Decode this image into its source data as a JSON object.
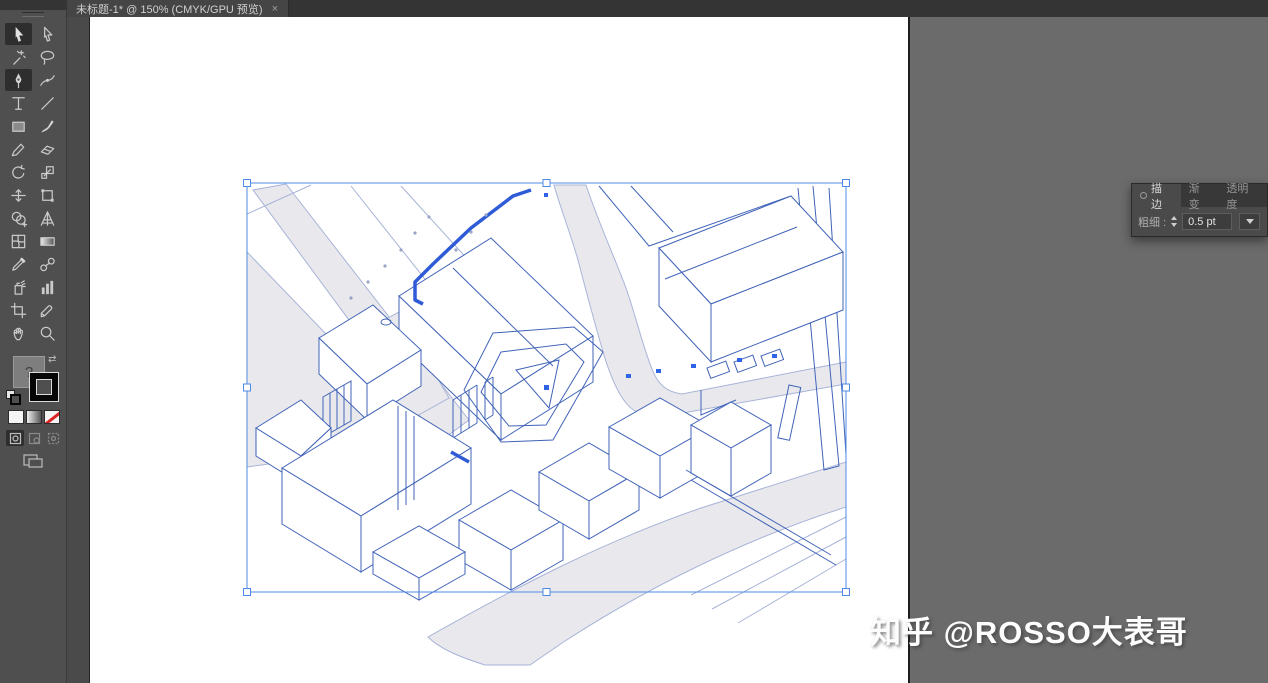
{
  "window": {
    "tab_title": "未标题-1* @ 150% (CMYK/GPU 预览)",
    "close_label": "×"
  },
  "toolbar": {
    "fill_indicator": "?",
    "tools": [
      {
        "id": "selection",
        "name": "selection-tool",
        "active": true
      },
      {
        "id": "direct-selection",
        "name": "direct-selection-tool",
        "active": false
      },
      {
        "id": "magic-wand",
        "name": "magic-wand-tool",
        "active": false
      },
      {
        "id": "lasso",
        "name": "lasso-tool",
        "active": false
      },
      {
        "id": "pen",
        "name": "pen-tool",
        "active": true
      },
      {
        "id": "curvature",
        "name": "curvature-tool",
        "active": false
      },
      {
        "id": "type",
        "name": "type-tool",
        "active": false
      },
      {
        "id": "line-segment",
        "name": "line-segment-tool",
        "active": false
      },
      {
        "id": "rectangle",
        "name": "rectangle-tool",
        "active": false
      },
      {
        "id": "paintbrush",
        "name": "paintbrush-tool",
        "active": false
      },
      {
        "id": "pencil",
        "name": "pencil-tool",
        "active": false
      },
      {
        "id": "eraser",
        "name": "eraser-tool",
        "active": false
      },
      {
        "id": "rotate",
        "name": "rotate-tool",
        "active": false
      },
      {
        "id": "scale",
        "name": "scale-tool",
        "active": false
      },
      {
        "id": "width",
        "name": "width-tool",
        "active": false
      },
      {
        "id": "free-transform",
        "name": "free-transform-tool",
        "active": false
      },
      {
        "id": "shape-builder",
        "name": "shape-builder-tool",
        "active": false
      },
      {
        "id": "perspective-grid",
        "name": "perspective-grid-tool",
        "active": false
      },
      {
        "id": "mesh",
        "name": "mesh-tool",
        "active": false
      },
      {
        "id": "gradient",
        "name": "gradient-tool",
        "active": false
      },
      {
        "id": "eyedropper",
        "name": "eyedropper-tool",
        "active": false
      },
      {
        "id": "blend",
        "name": "blend-tool",
        "active": false
      },
      {
        "id": "symbol-sprayer",
        "name": "symbol-sprayer-tool",
        "active": false
      },
      {
        "id": "column-graph",
        "name": "column-graph-tool",
        "active": false
      },
      {
        "id": "artboard",
        "name": "artboard-tool",
        "active": false
      },
      {
        "id": "slice",
        "name": "slice-tool",
        "active": false
      },
      {
        "id": "hand",
        "name": "hand-tool",
        "active": false
      },
      {
        "id": "zoom",
        "name": "zoom-tool",
        "active": false
      }
    ]
  },
  "panel": {
    "tabs": [
      {
        "id": "stroke",
        "label": "描边",
        "active": true
      },
      {
        "id": "gradient",
        "label": "渐变",
        "active": false
      },
      {
        "id": "opacity",
        "label": "透明度",
        "active": false
      }
    ],
    "weight_label": "粗细 :",
    "weight_value": "0.5 pt"
  },
  "watermark": "知乎 @ROSSO大表哥",
  "colors": {
    "selection_blue": "#4e8be8",
    "artwork_stroke": "#4063b8",
    "road_fill": "#e9e9ed",
    "thick_path_blue": "#2f5cd6",
    "canvas_white": "#ffffff",
    "ui_dark": "#4f4f4f"
  }
}
